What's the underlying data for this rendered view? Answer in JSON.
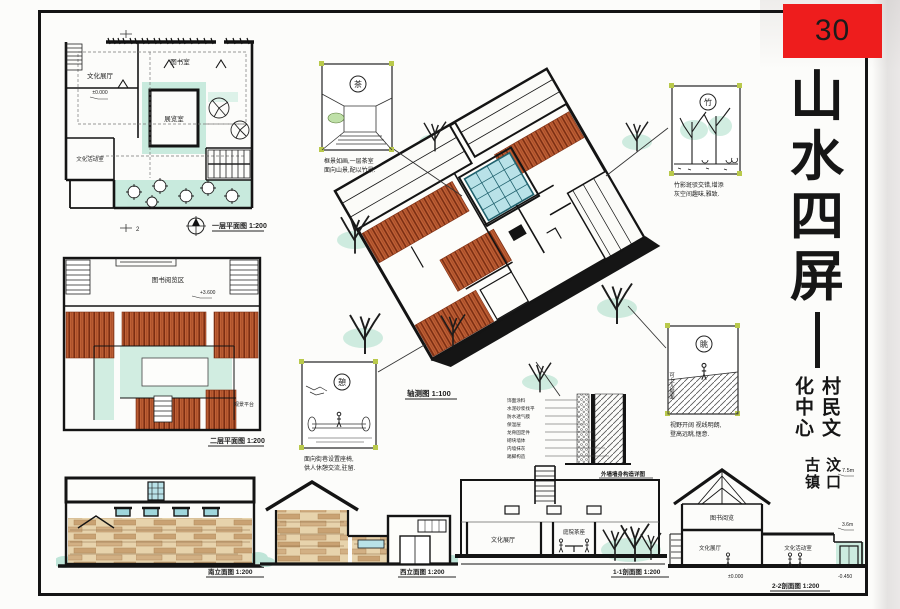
{
  "sheet": {
    "number": "30",
    "grid_tick_label": "2"
  },
  "title": {
    "chars": [
      "山",
      "水",
      "四",
      "屏"
    ],
    "subtitle_right": "村民文化中心",
    "subtitle_left": "汶口古镇"
  },
  "plan1": {
    "caption": "一层平面图 1:200",
    "rooms": {
      "exhibition": "文化展厅",
      "library": "图书室",
      "multi": "展览室",
      "activity": "文化活动室"
    },
    "level_mark": "±0.000"
  },
  "plan2": {
    "caption": "二层平面图 1:200",
    "rooms": {
      "reading": "图书阅览区",
      "view": "观景平台"
    },
    "level_mark": "+3.600"
  },
  "axon": {
    "caption": "轴测图 1:100"
  },
  "callouts": {
    "tea": {
      "glyph": "茶",
      "line1": "框景如画,一层茶室",
      "line2": "面向山景,配以竹景."
    },
    "bamboo": {
      "glyph": "竹",
      "line1": "竹影斑驳交错,增添",
      "line2": "灰空间趣味,雅致."
    },
    "view": {
      "glyph": "眺",
      "side": "可上人屋面",
      "line1": "视野开阔 视线明朗,",
      "line2": "登高远眺,惬意."
    },
    "rest": {
      "glyph": "憩",
      "line1": "面向街巷设置座椅,",
      "line2": "供人休憩交流,驻留."
    }
  },
  "wall_detail": {
    "caption": "外墙墙身构造详图",
    "layers": [
      "饰面涂料",
      "水泥砂浆找平",
      "防水透气膜",
      "保温层",
      "龙骨固定件",
      "砌块墙体",
      "内墙抹灰",
      "踢脚构造"
    ]
  },
  "elevations": {
    "south": {
      "caption": "南立面图 1:200"
    },
    "west": {
      "caption": "西立面图 1:200"
    },
    "section1": {
      "caption": "1-1剖面图 1:200",
      "rooms": {
        "left": "文化展厅",
        "mid": "庭院茶座"
      }
    },
    "section2": {
      "caption": "2-2剖面图 1:200",
      "rooms": {
        "top": "图书阅览",
        "left": "文化展厅",
        "mid": "文化活动室"
      },
      "marks": {
        "top": "7.5m",
        "mid": "3.6m",
        "zero": "±0.000",
        "low": "-0.450"
      }
    }
  },
  "colors": {
    "accent_red": "#ee1d1d",
    "terracotta": "#b4512e",
    "teal": "#bfe7d8",
    "glass": "#b9e2e8",
    "wood": "#d2b084"
  }
}
